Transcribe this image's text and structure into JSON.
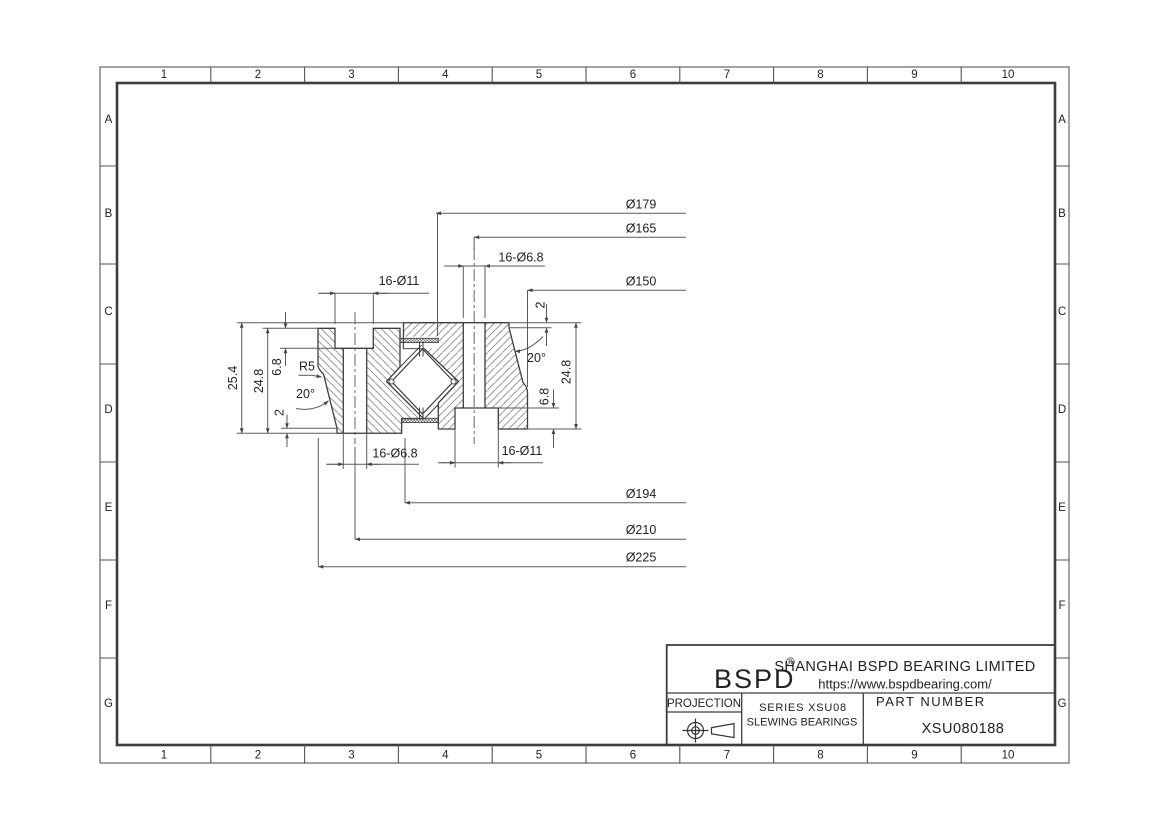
{
  "frame": {
    "cols": [
      "1",
      "2",
      "3",
      "4",
      "5",
      "6",
      "7",
      "8",
      "9",
      "10"
    ],
    "rows": [
      "A",
      "B",
      "C",
      "D",
      "E",
      "F",
      "G"
    ]
  },
  "title_block": {
    "logo": "BSPD",
    "registered": "®",
    "company": "SHANGHAI BSPD BEARING LIMITED",
    "website": "https://www.bspdbearing.com/",
    "projection_label": "PROJECTION",
    "series_line1": "SERIES XSU08",
    "series_line2": "SLEWING BEARINGS",
    "part_number_label": "PART NUMBER",
    "part_number": "XSU080188"
  },
  "dimensions": {
    "dia179": "Ø179",
    "dia165": "Ø165",
    "holes68_top": "16-Ø6.8",
    "dia150": "Ø150",
    "lip2_top": "2",
    "angle20_right": "20°",
    "h248_right": "24.8",
    "d68_right": "6.8",
    "holes11_bottom": "16-Ø11",
    "holes68_bottom": "16-Ø6.8",
    "holes11_top": "16-Ø11",
    "d68_left": "6.8",
    "h248_left": "24.8",
    "h254": "25.4",
    "r5": "R5",
    "angle20_left": "20°",
    "lip2_bottom": "2",
    "dia194": "Ø194",
    "dia210": "Ø210",
    "dia225": "Ø225"
  },
  "colors": {
    "outline": "#3d3d3d",
    "dimline": "#5a5a5a",
    "hatch": "#8a8a8a",
    "background": "#ffffff"
  }
}
